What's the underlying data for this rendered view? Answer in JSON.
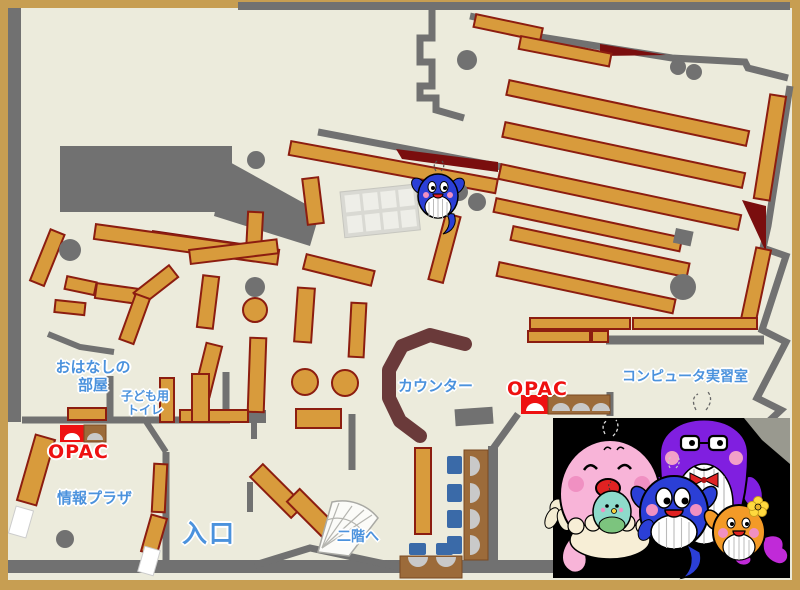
{
  "map": {
    "title": "library-first-floor-map",
    "labels": {
      "storytime_room_line1": "おはなしの",
      "storytime_room_line2": "部屋",
      "kids_toilet_line1": "子ども用",
      "kids_toilet_line2": "トイレ",
      "opac_left": "OPAC",
      "opac_right": "OPAC",
      "info_plaza": "情報プラザ",
      "entrance": "入口",
      "stairs_up": "二階へ",
      "counter": "カウンター",
      "computer_room": "コンピュータ実習室"
    },
    "colors": {
      "frame_tan": "#c79e52",
      "floor_cream": "#ecebdc",
      "wall_gray": "#717171",
      "shelf_orange": "#d89b3c",
      "shelf_border_red": "#8c1d10",
      "accent_dark_red": "#7a0e0e",
      "counter_brown": "#6a3a3a",
      "table_brown": "#9c6b3a",
      "chair_blue": "#3a6aa8",
      "label_blue": "#4b92dd",
      "opac_red": "#ee1111",
      "photo_black": "#000000"
    },
    "icons": {
      "small_mascot": "blue-whale-mascot-icon",
      "family_illustration": [
        "pink-whale-parent",
        "teal-baby-whale",
        "blue-whale-child",
        "purple-whale-parent",
        "orange-whale-child"
      ],
      "stairs": "spiral-stairs-icon",
      "opac_terminal": "opac-terminal-icon"
    }
  }
}
